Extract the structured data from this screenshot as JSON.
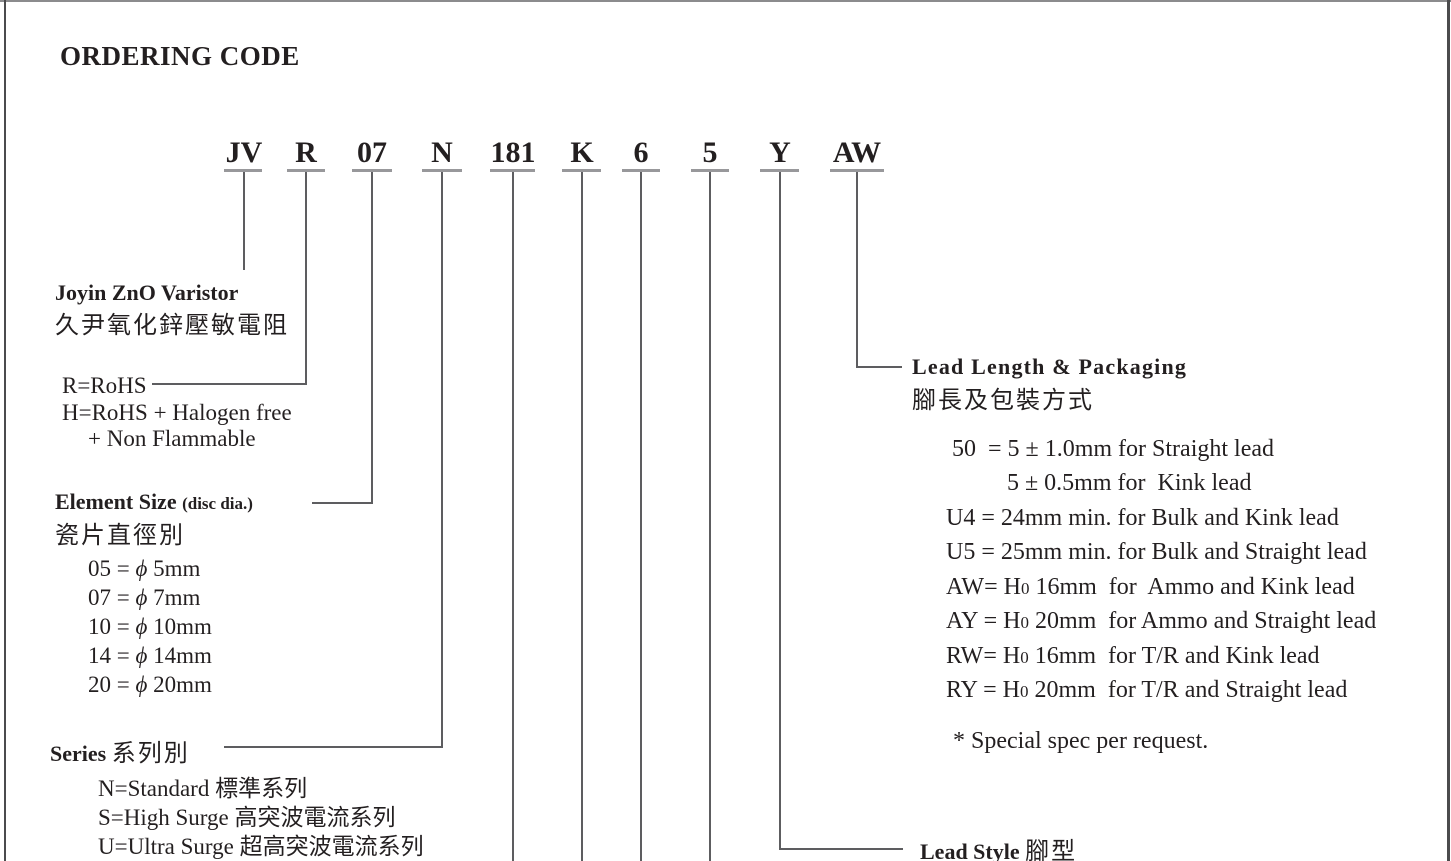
{
  "page": {
    "title": "ORDERING CODE"
  },
  "code": {
    "parts": [
      "JV",
      "R",
      "07",
      "N",
      "181",
      "K",
      "6",
      "5",
      "Y",
      "AW"
    ]
  },
  "sections": {
    "manufacturer": {
      "title": "Joyin ZnO Varistor",
      "subtitle": "久尹氧化鋅壓敏電阻"
    },
    "rohs": {
      "options": [
        "R=RoHS",
        "H=RoHS + Halogen free",
        "+ Non Flammable"
      ]
    },
    "element_size": {
      "title": "Element Size",
      "note": "(disc dia.)",
      "subtitle": "瓷片直徑別",
      "options": [
        {
          "pre": "05 = ",
          "phi": "ϕ",
          "post": " 5mm"
        },
        {
          "pre": "07 = ",
          "phi": "ϕ",
          "post": " 7mm"
        },
        {
          "pre": "10 = ",
          "phi": "ϕ",
          "post": " 10mm"
        },
        {
          "pre": "14 = ",
          "phi": "ϕ",
          "post": " 14mm"
        },
        {
          "pre": "20 = ",
          "phi": "ϕ",
          "post": " 20mm"
        }
      ]
    },
    "series": {
      "title": "Series",
      "subtitle": "系列別",
      "options": [
        "N=Standard 標準系列",
        "S=High Surge 高突波電流系列",
        "U=Ultra Surge 超高突波電流系列"
      ]
    },
    "lead_length_packaging": {
      "title": "Lead Length & Packaging",
      "subtitle": "腳長及包裝方式",
      "options": [
        {
          "pre": "50  = 5 ± 1.0mm for Straight lead"
        },
        {
          "pre": "5 ± 0.5mm for  Kink lead"
        },
        {
          "pre": "U4 = 24mm min. for Bulk and Kink lead"
        },
        {
          "pre": "U5 = 25mm min. for Bulk and Straight lead"
        },
        {
          "pre": "AW= H",
          "sub": "0",
          "post": " 16mm  for  Ammo and Kink lead"
        },
        {
          "pre": "AY = H",
          "sub": "0",
          "post": " 20mm  for Ammo and Straight lead"
        },
        {
          "pre": "RW= H",
          "sub": "0",
          "post": " 16mm  for T/R and Kink lead"
        },
        {
          "pre": "RY = H",
          "sub": "0",
          "post": " 20mm  for T/R and Straight lead"
        }
      ],
      "footnote": "* Special spec per request."
    },
    "lead_style": {
      "title": "Lead Style",
      "subtitle": "腳型"
    }
  }
}
